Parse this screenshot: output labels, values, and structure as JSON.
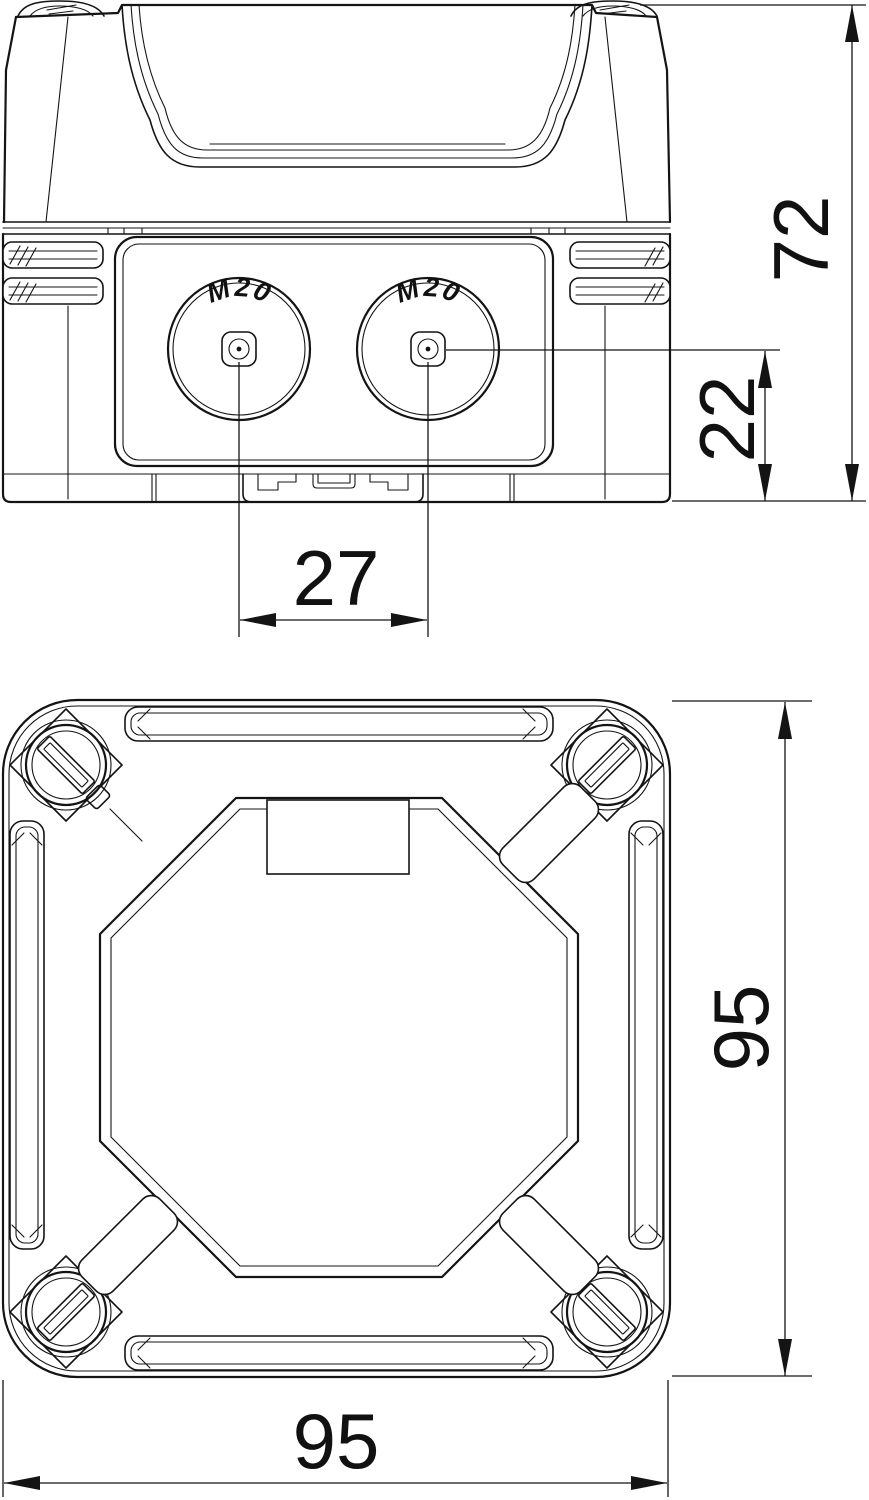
{
  "drawing": {
    "type": "technical-drawing-junction-box",
    "background": "#ffffff",
    "line_color": "#141414",
    "front_view": {
      "knockout_left_label": "M20",
      "knockout_right_label": "M20"
    },
    "dimensions": {
      "overall_height": "72",
      "entry_center_height": "22",
      "entry_spacing": "27",
      "body_width": "95",
      "body_depth": "95"
    }
  }
}
